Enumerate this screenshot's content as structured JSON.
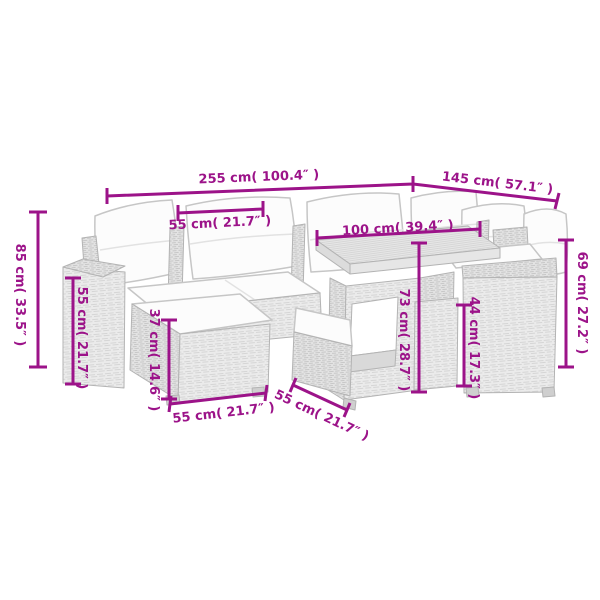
{
  "diagram": {
    "accent_color": "#9c1389",
    "background_color": "#ffffff",
    "dims": [
      {
        "id": "overall-width",
        "cm": 255,
        "inch": 100.4,
        "label": "255 cm( 100.4″ )"
      },
      {
        "id": "overall-depth",
        "cm": 145,
        "inch": 57.1,
        "label": "145 cm( 57.1″ )"
      },
      {
        "id": "seat-width",
        "cm": 55,
        "inch": 21.7,
        "label": "55 cm( 21.7″ )"
      },
      {
        "id": "table-length",
        "cm": 100,
        "inch": 39.4,
        "label": "100 cm( 39.4″ )"
      },
      {
        "id": "overall-height",
        "cm": 85,
        "inch": 33.5,
        "label": "85 cm( 33.5″ )"
      },
      {
        "id": "backrest-height",
        "cm": 55,
        "inch": 21.7,
        "label": "55 cm( 21.7″ )"
      },
      {
        "id": "footstool-height",
        "cm": 37,
        "inch": 14.6,
        "label": "37 cm( 14.6″ )"
      },
      {
        "id": "table-height",
        "cm": 73,
        "inch": 28.7,
        "label": "73 cm( 28.7″ )"
      },
      {
        "id": "seat-height",
        "cm": 44,
        "inch": 17.3,
        "label": "44 cm( 17.3″ )"
      },
      {
        "id": "armrest-height",
        "cm": 69,
        "inch": 27.2,
        "label": "69 cm( 27.2″ )"
      },
      {
        "id": "footstool-width",
        "cm": 55,
        "inch": 21.7,
        "label": "55 cm( 21.7″ )"
      },
      {
        "id": "module-depth",
        "cm": 55,
        "inch": 21.7,
        "label": "55 cm( 21.7″ )"
      }
    ]
  }
}
